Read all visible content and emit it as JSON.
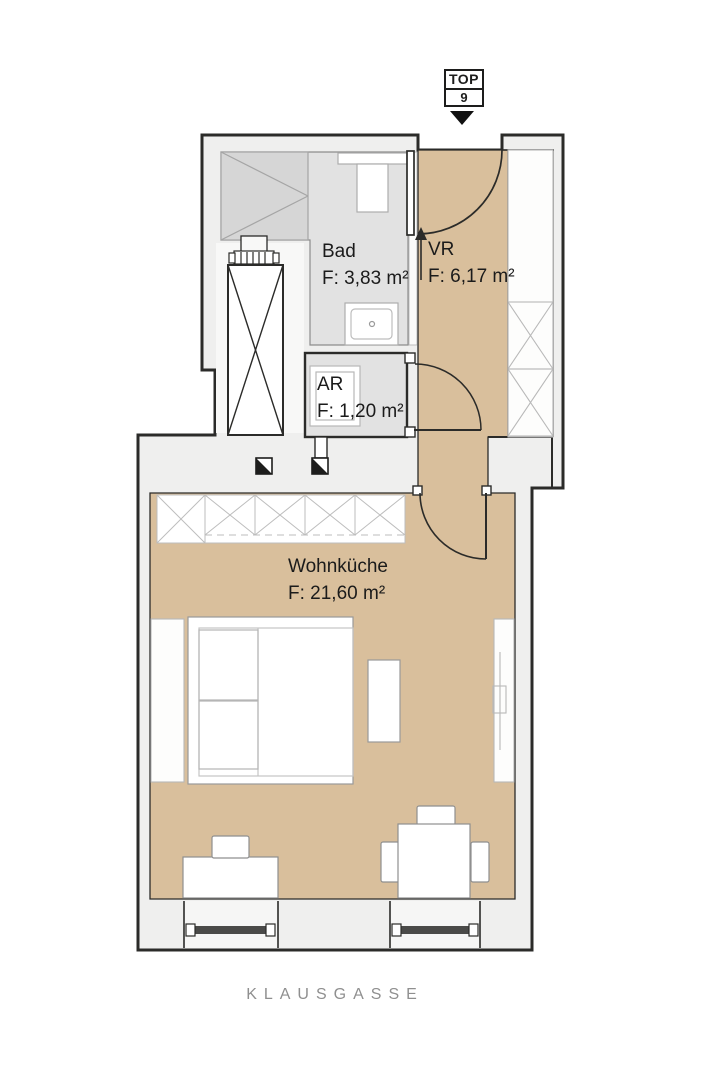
{
  "plan": {
    "title_badge": {
      "line1": "TOP",
      "line2": "9"
    },
    "rooms": [
      {
        "id": "bad",
        "name": "Bad",
        "area": "F: 3,83 m²"
      },
      {
        "id": "vr",
        "name": "VR",
        "area": "F: 6,17 m²"
      },
      {
        "id": "ar",
        "name": "AR",
        "area": "F: 1,20 m²"
      },
      {
        "id": "wohnkueche",
        "name": "Wohnküche",
        "area": "F: 21,60 m²"
      }
    ],
    "street_label": "KLAUSGASSE",
    "icons": [
      {
        "name": "entrance-arrow-icon",
        "shape": "down-triangle"
      },
      {
        "name": "duct-marker-icon",
        "shape": "half-filled-square"
      }
    ],
    "colors": {
      "floor_tan": "#d9bf9c",
      "room_gray": "#e2e2e2",
      "wall_fill": "#efefee",
      "outline": "#2b2b29"
    }
  }
}
